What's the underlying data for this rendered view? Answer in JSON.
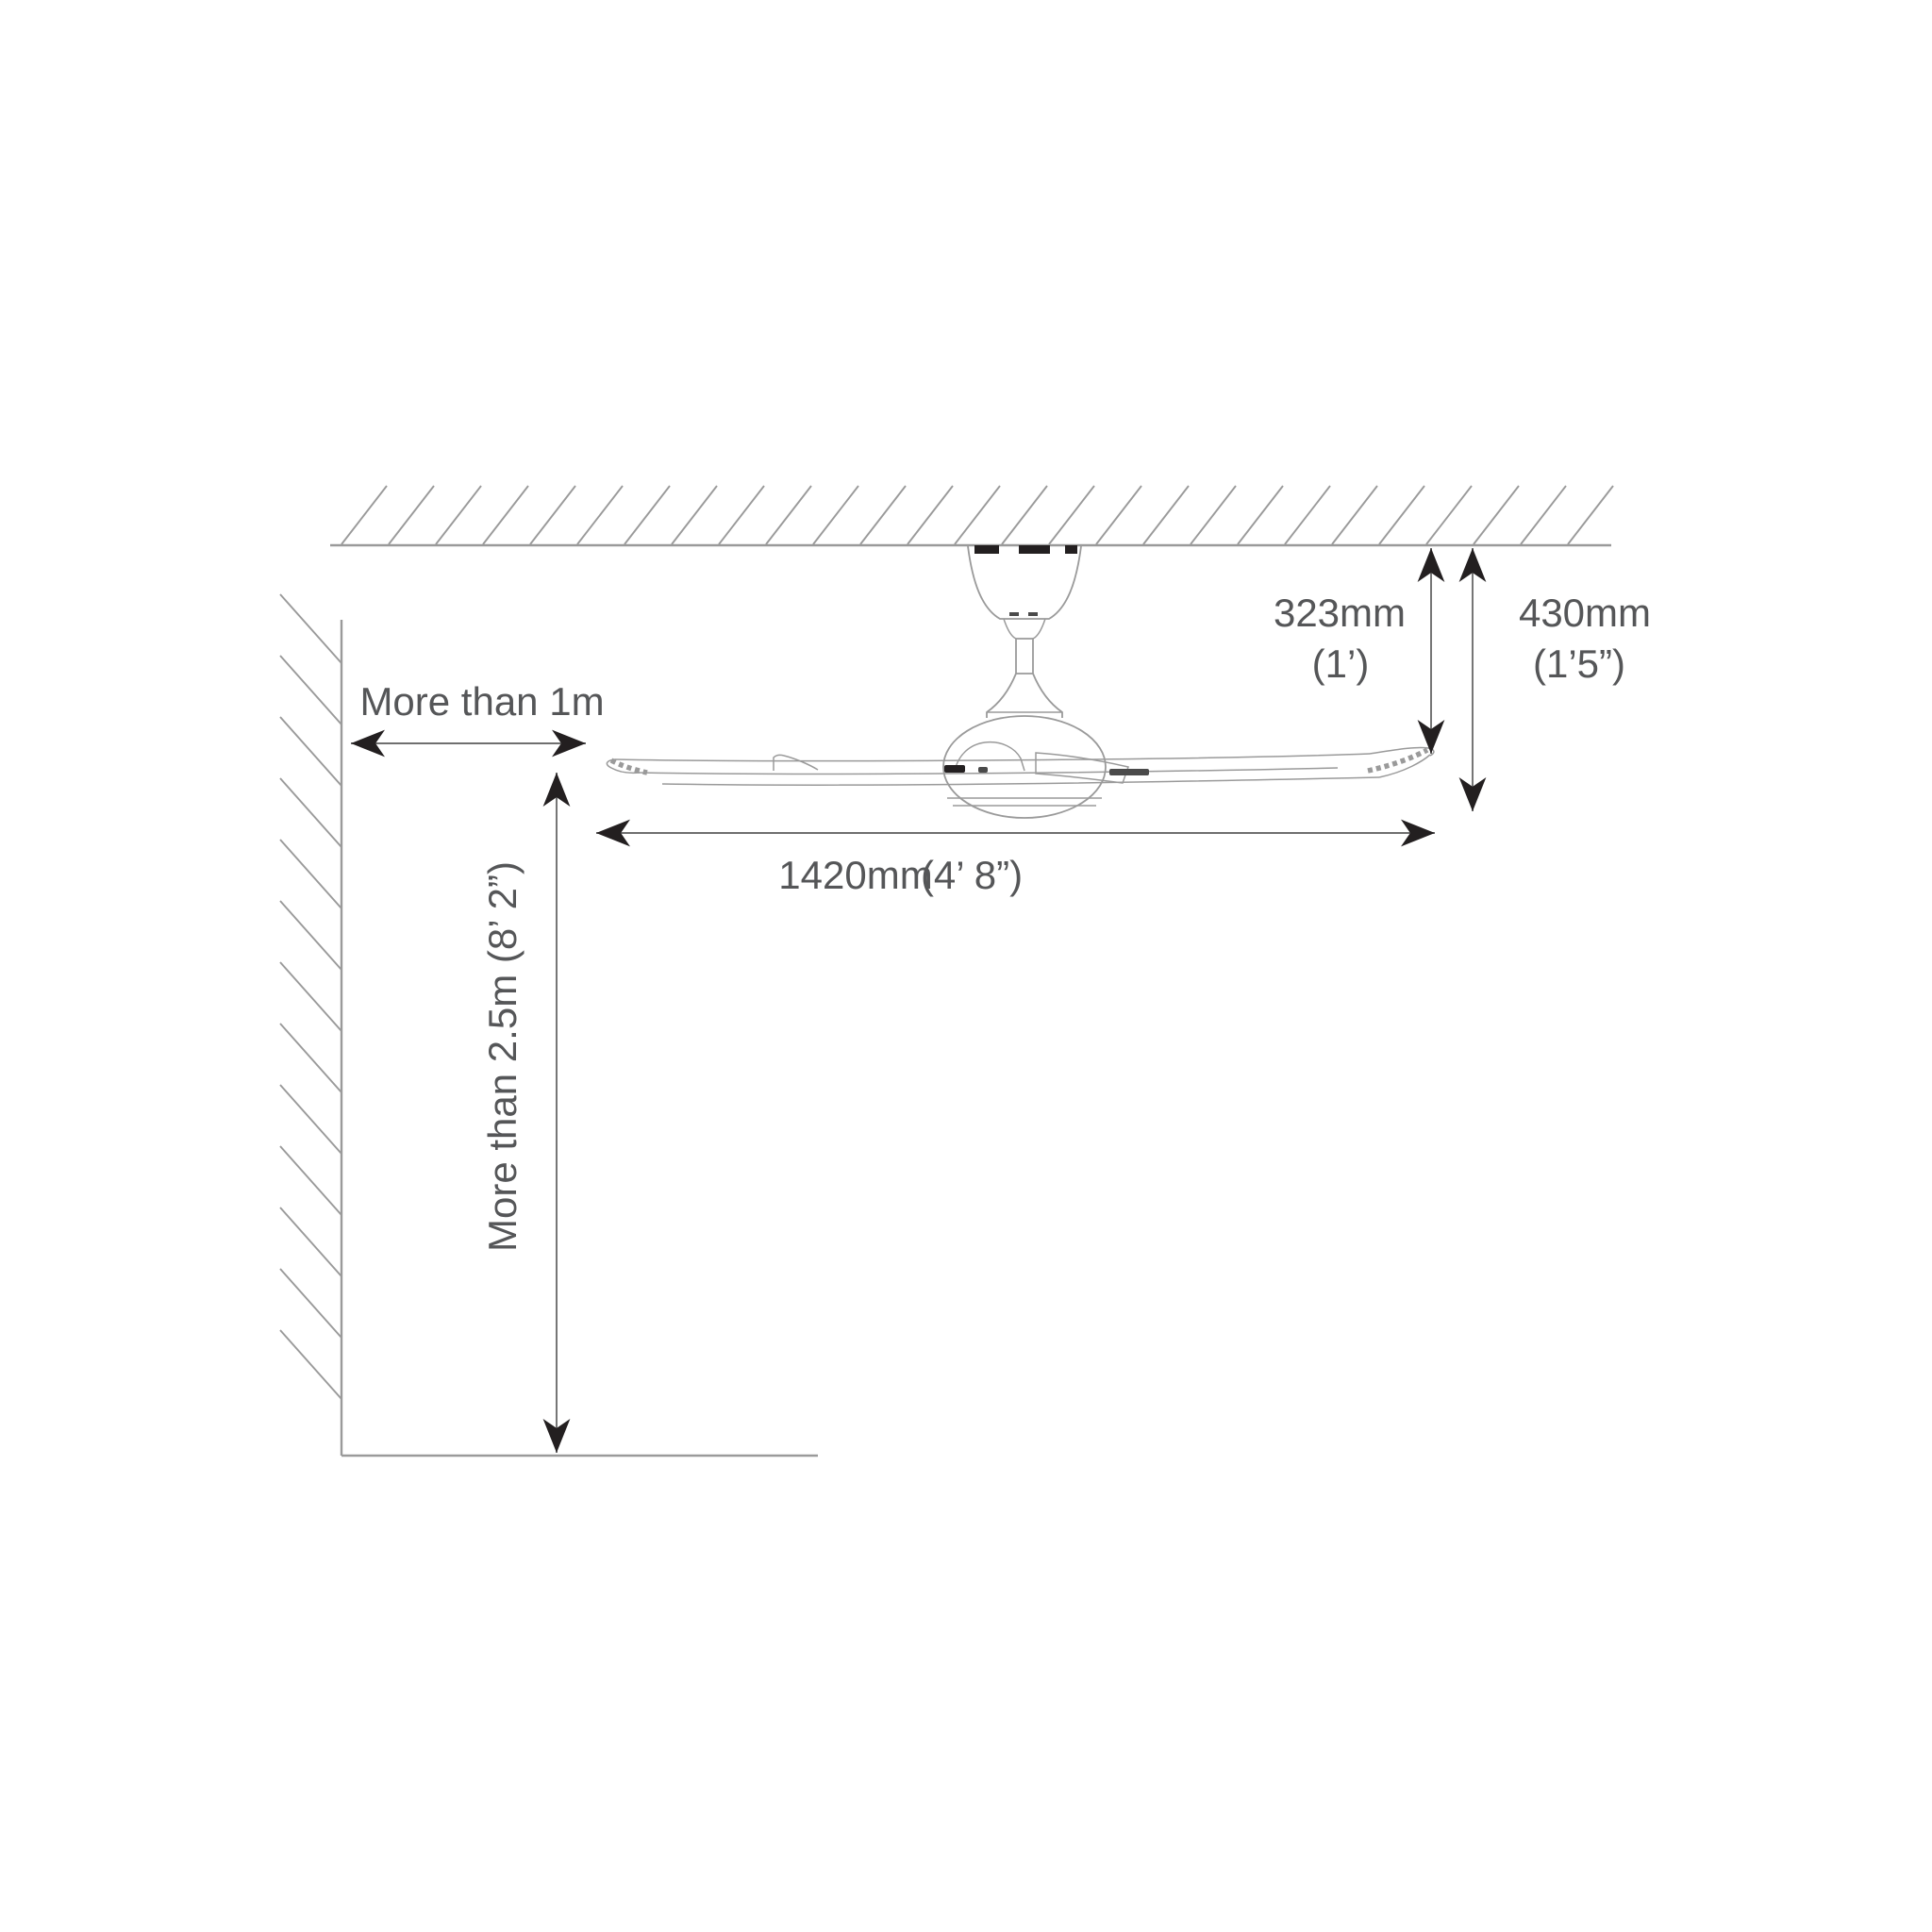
{
  "diagram": {
    "subject": "ceiling-fan-installation-clearances",
    "labels": {
      "wall_clearance": "More than 1m",
      "floor_clearance": "More than 2.5m (8’ 2”)",
      "ceiling_to_blade_mm": "323mm",
      "ceiling_to_blade_imperial": "(1’)",
      "ceiling_to_fan_bottom_mm": "430mm",
      "ceiling_to_fan_bottom_imperial": "(1’5”)",
      "blade_span_mm": "1420mm",
      "blade_span_imperial": "(4’ 8”)"
    },
    "colors": {
      "background": "#ffffff",
      "line": "#9a9a9a",
      "dimension_line": "#6f6f6f",
      "arrowhead": "#231f20",
      "text": "#555658"
    }
  }
}
